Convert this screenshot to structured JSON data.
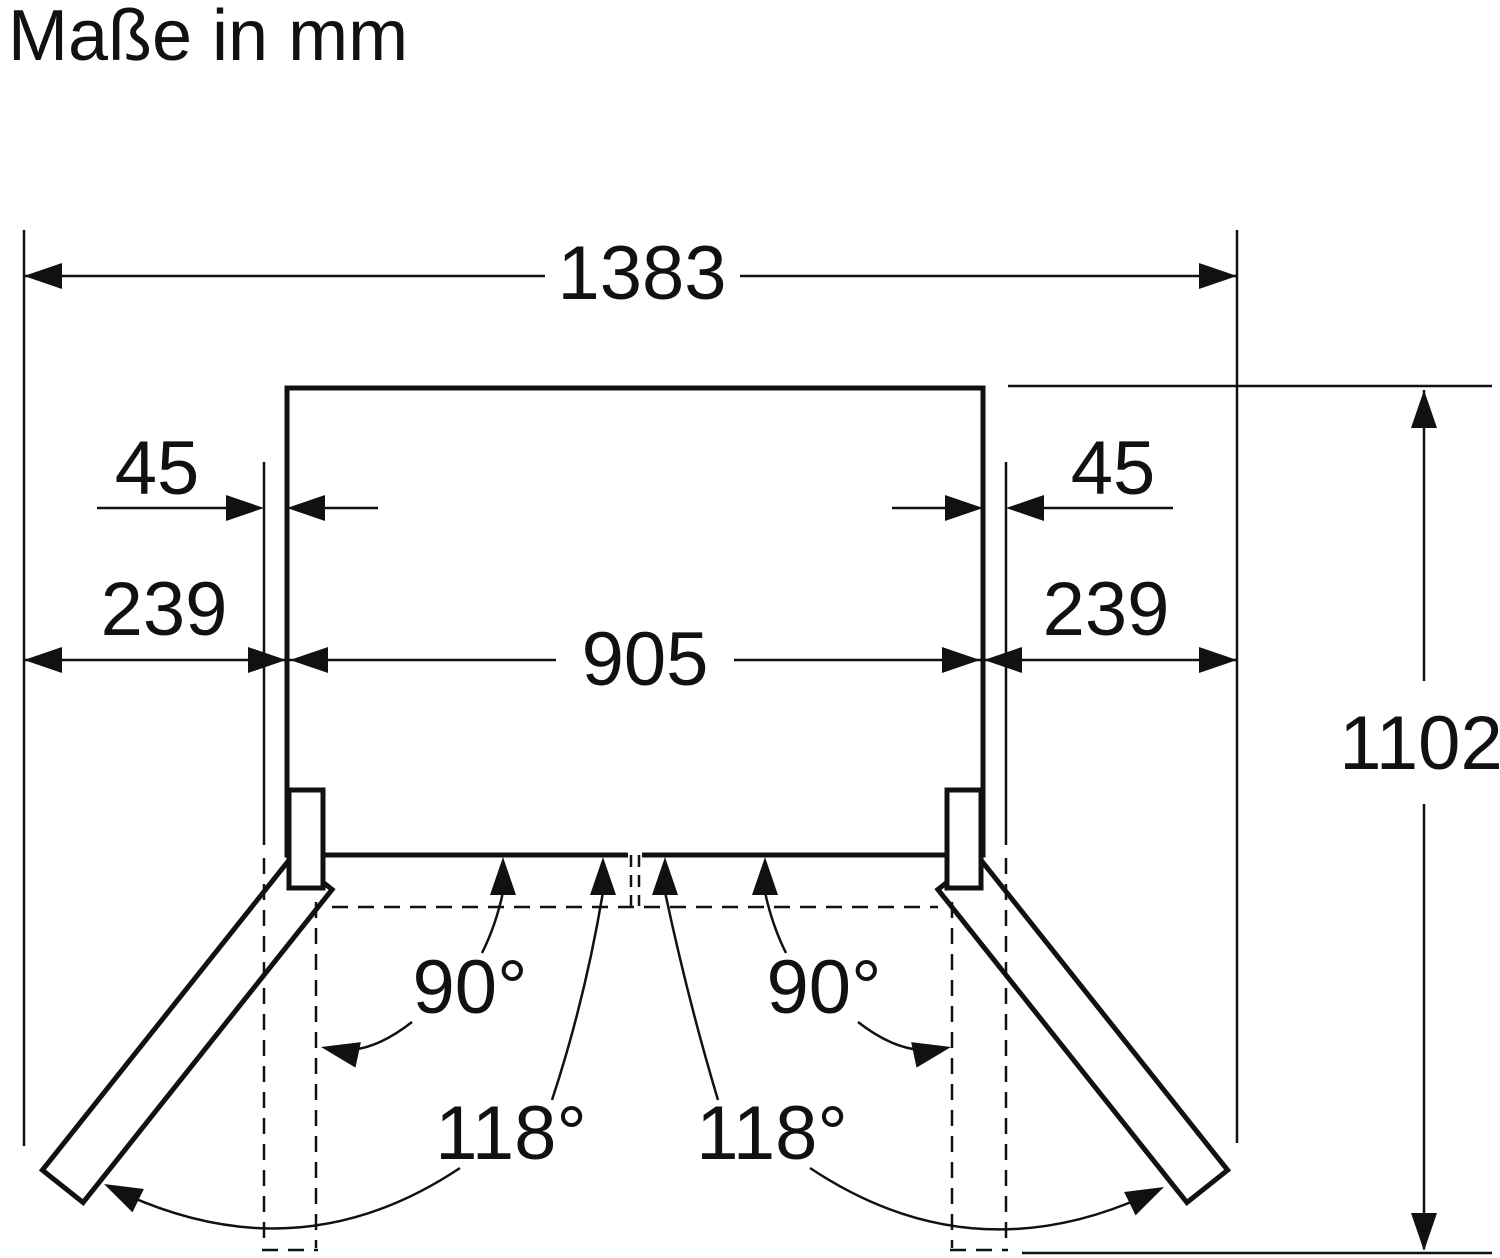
{
  "title": "Maße in mm",
  "unit": "mm",
  "figure_type": "appliance top view with door opening clearances",
  "labels": {
    "overall_width": "1383",
    "hinge_offset_left": "45",
    "hinge_offset_right": "45",
    "door_clearance_left": "239",
    "door_clearance_right": "239",
    "body_width": "905",
    "overall_depth_doors_open": "1102",
    "opening_angle_90_left": "90°",
    "opening_angle_90_right": "90°",
    "opening_angle_118_left": "118°",
    "opening_angle_118_right": "118°"
  },
  "colors": {
    "line": "#111111",
    "background": "#ffffff"
  }
}
